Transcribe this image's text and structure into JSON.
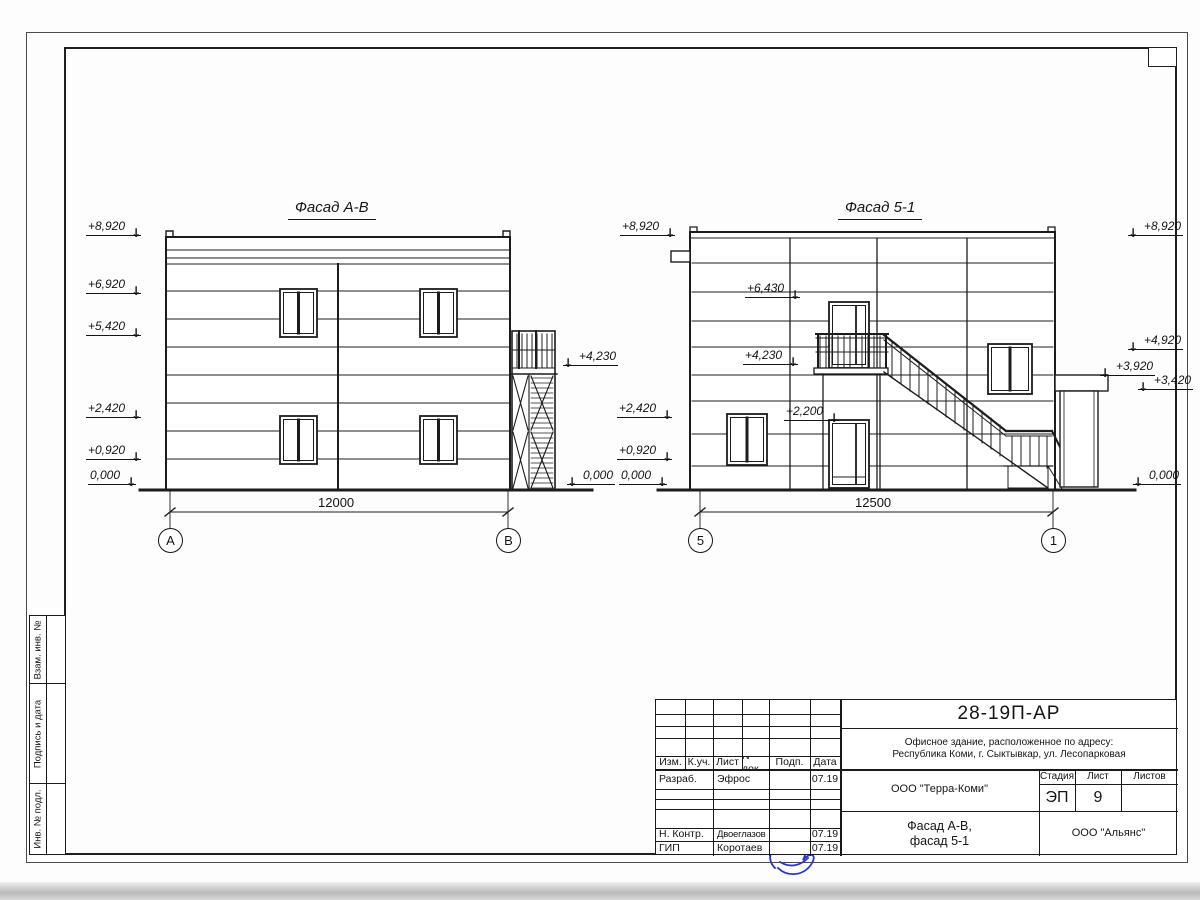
{
  "drawing": {
    "facade_ab": {
      "title": "Фасад А-В",
      "marks_left": [
        "+8,920",
        "+6,920",
        "+5,420",
        "+2,420",
        "+0,920",
        "0,000"
      ],
      "marks_right": [
        "+4,230",
        "0,000"
      ],
      "dimension": "12000",
      "axes": [
        "А",
        "В"
      ]
    },
    "facade_51": {
      "title": "Фасад 5-1",
      "marks_left": [
        "+8,920",
        "+2,420",
        "+0,920",
        "0,000"
      ],
      "marks_inner": [
        "+6,430",
        "+4,230",
        "+2,200"
      ],
      "marks_right": [
        "+8,920",
        "+4,920",
        "+3,920",
        "+3,420",
        "0,000"
      ],
      "dimension": "12500",
      "axes": [
        "5",
        "1"
      ]
    }
  },
  "stamp": {
    "code": "28-19П-АР",
    "address_line1": "Офисное здание, расположенное по адресу:",
    "address_line2": "Республика Коми, г. Сыктывкар, ул. Лесопарковая",
    "designer_org": "ООО \"Терра-Коми\"",
    "contractor_org": "ООО \"Альянс\"",
    "sheet_title_line1": "Фасад А-В,",
    "sheet_title_line2": "фасад 5-1",
    "stage_label": "Стадия",
    "sheet_label": "Лист",
    "sheets_label": "Листов",
    "stage": "ЭП",
    "sheet": "9",
    "sheets": "",
    "header": {
      "izm": "Изм.",
      "kuch": "К.уч.",
      "list": "Лист",
      "ndok": "N док.",
      "podp": "Подп.",
      "data": "Дата"
    },
    "rows": [
      {
        "role": "Разраб.",
        "name": "Эфрос",
        "date": "07.19"
      },
      {
        "role": "Н. Контр.",
        "name": "Двоеглазов",
        "date": "07.19"
      },
      {
        "role": "ГИП",
        "name": "Коротаев",
        "date": "07.19"
      }
    ]
  },
  "sidebar": {
    "cells": [
      "Взам. инв. №",
      "Подпись и дата",
      "Инв. № подл."
    ]
  }
}
